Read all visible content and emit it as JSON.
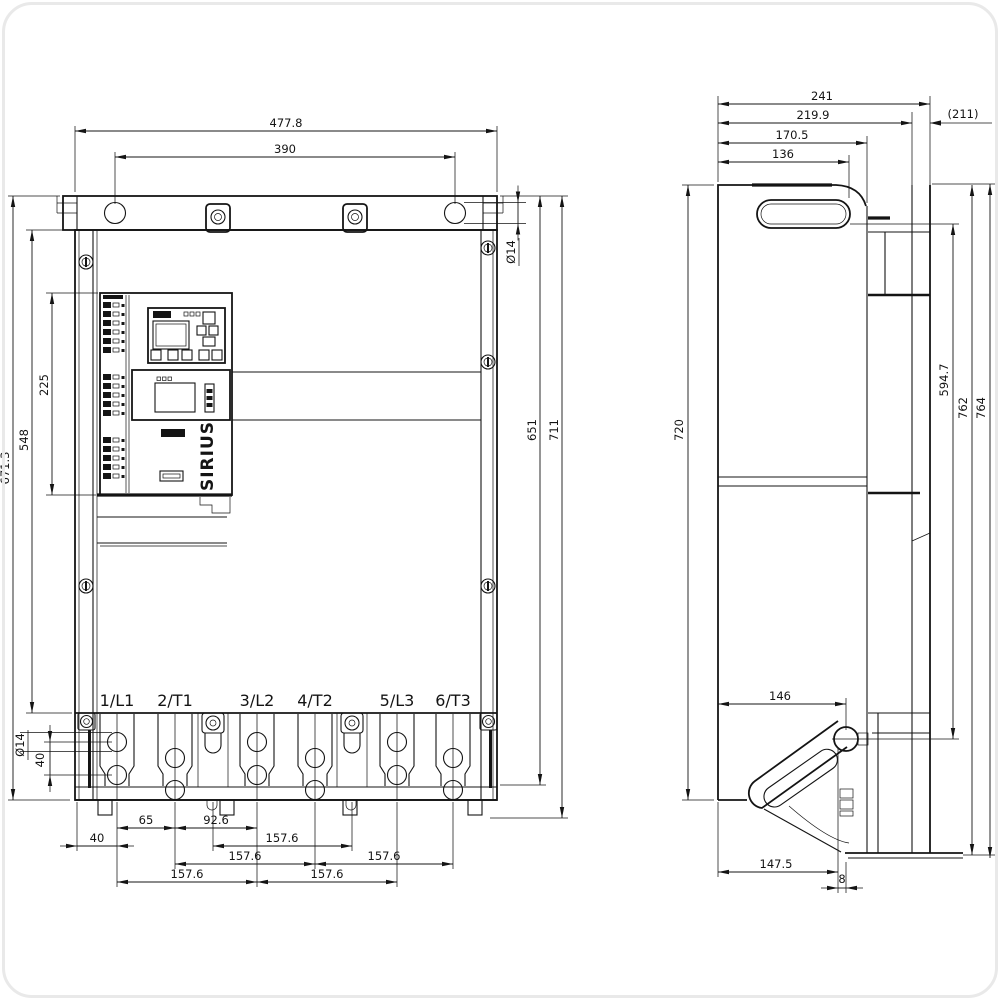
{
  "page": {
    "background": "#ffffff",
    "line_color": "#141414"
  },
  "front_view": {
    "label": "front view",
    "brand": "SIRIUS",
    "terminals": [
      "1/L1",
      "2/T1",
      "3/L2",
      "4/T2",
      "5/L3",
      "6/T3"
    ],
    "dims": {
      "overall_width": "477.8",
      "hole_spacing_x": "390",
      "overall_height": "671.3",
      "body_height": "548",
      "module_height": "225",
      "hole_dia": "Ø14",
      "hole_pitch_40": "40",
      "height_651": "651",
      "height_711": "711",
      "edge_offset_40": "40",
      "l1_t1_65": "65",
      "t1_l2_92_6": "92.6",
      "pitch_157_6": "157.6"
    }
  },
  "side_view": {
    "label": "side view",
    "dims": {
      "depth_241": "241",
      "depth_219_9": "219.9",
      "depth_211_aux": "(211)",
      "depth_170_5": "170.5",
      "depth_136": "136",
      "plate_height_720": "720",
      "slot_to_hole_594_7": "594.7",
      "height_762": "762",
      "height_764": "764",
      "hole_offset_146": "146",
      "bracket_147_5": "147.5",
      "lip_8": "8"
    }
  }
}
